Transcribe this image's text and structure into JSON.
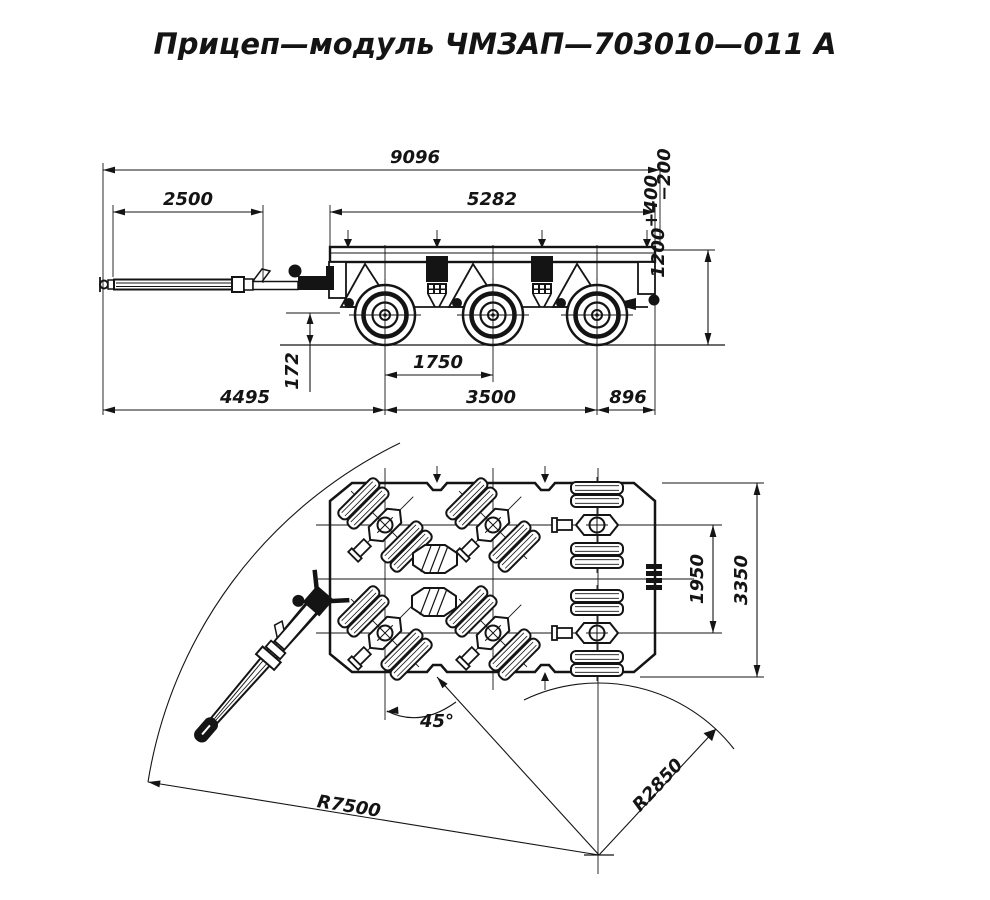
{
  "title": "Прицеп—модуль ЧМЗАП—703010—011 А",
  "colors": {
    "line": "#141414",
    "background": "#ffffff"
  },
  "side_view": {
    "dimensions": {
      "overall_length": "9096",
      "drawbar_extension": "2500",
      "platform_length": "5282",
      "platform_height": "1200",
      "platform_height_tol_upper": "+400",
      "platform_height_tol_lower": "−200",
      "ground_clearance": "172",
      "axle_spacing": "1750",
      "front_section_length": "4495",
      "bogie_wheelbase": "3500",
      "rear_overhang": "896"
    }
  },
  "plan_view": {
    "dimensions": {
      "bogie_track": "1950",
      "overall_width": "3350",
      "steering_angle": "45°",
      "outer_turning_radius": "R7500",
      "inner_turning_radius": "R2850"
    }
  }
}
